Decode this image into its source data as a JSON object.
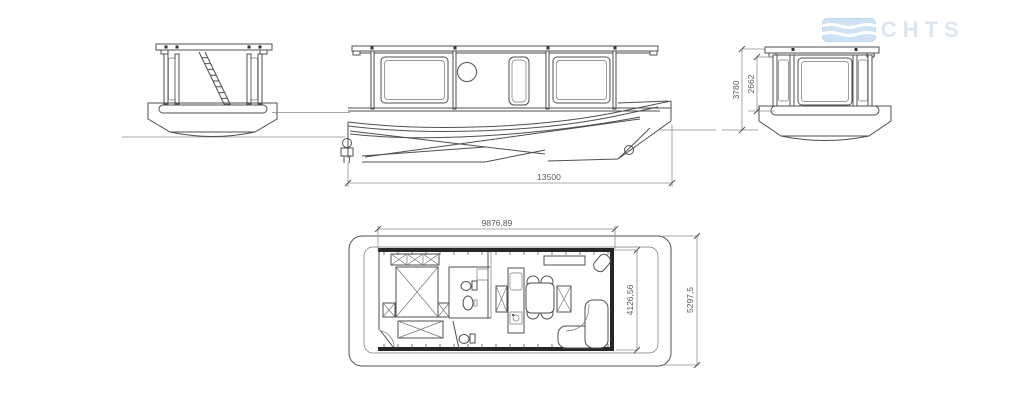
{
  "watermark": {
    "brand": "2YACHTS",
    "icon": "flag-icon"
  },
  "drawing": {
    "dimensions": {
      "side_length": "13500",
      "bow_overall_height": "3780",
      "bow_cabin_height": "2662",
      "plan_cabin_length": "9876,89",
      "plan_inner_beam": "4126,56",
      "plan_overall_beam": "5297,5"
    },
    "colors": {
      "background": "#ffffff",
      "line": "#4f4f4f",
      "wall": "#262626",
      "dim_line": "#8f8f8f",
      "dim_text": "#5a5a5a",
      "waterline": "#8a8a8a",
      "watermark_text": "#dde5ee",
      "watermark_flag": "#cfe2f4"
    }
  }
}
